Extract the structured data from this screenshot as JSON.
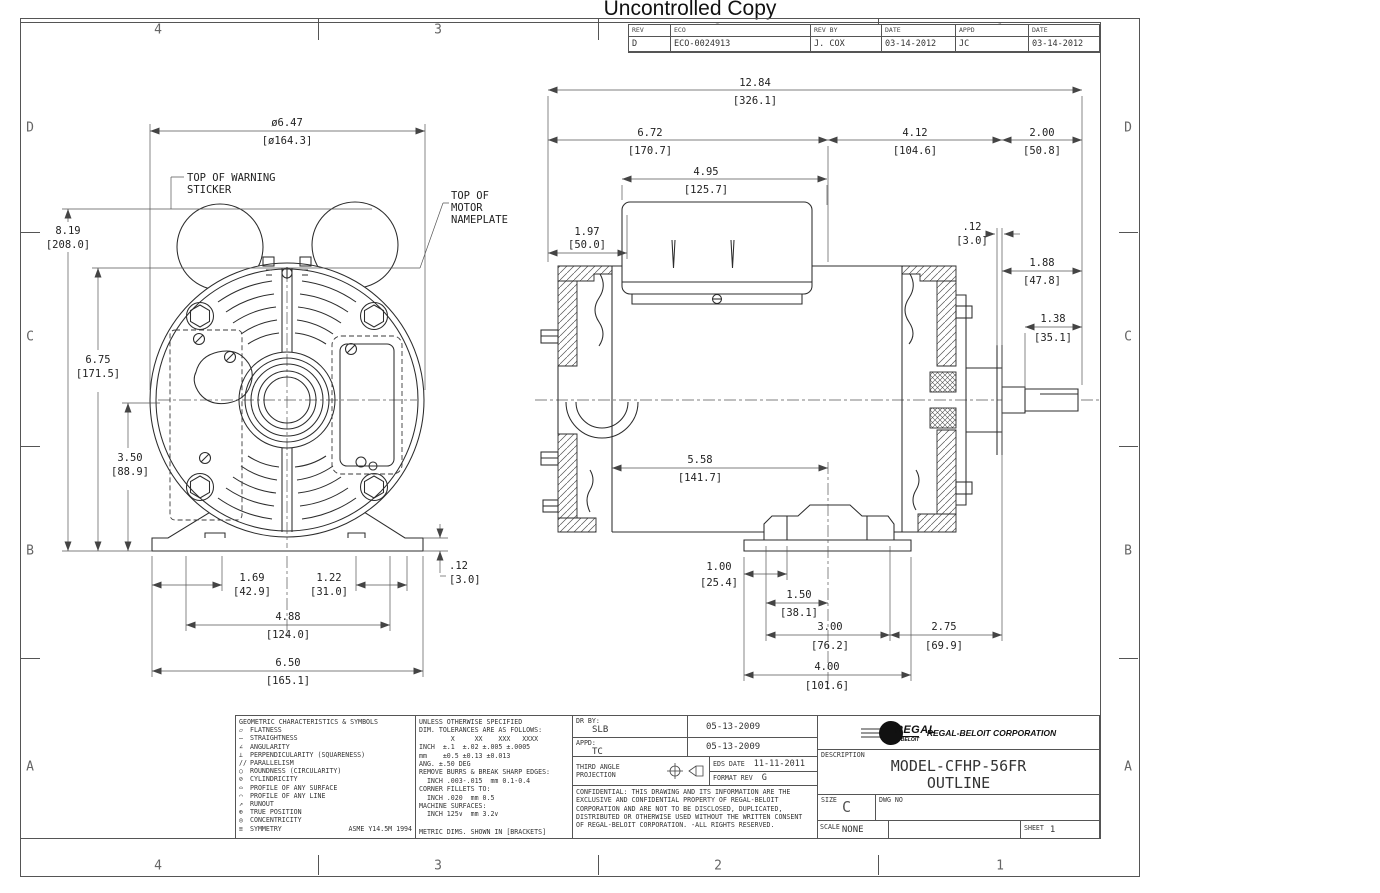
{
  "page_title": "Uncontrolled Copy",
  "sheet": {
    "zones_h": [
      "4",
      "3",
      "2",
      "1"
    ],
    "zones_v": [
      "D",
      "C",
      "B",
      "A"
    ]
  },
  "revision_table": {
    "headers": [
      "REV",
      "ECO",
      "REV BY",
      "DATE",
      "APPD",
      "DATE"
    ],
    "row": [
      "D",
      "ECO-0024913",
      "J. COX",
      "03-14-2012",
      "JC",
      "03-14-2012"
    ]
  },
  "callouts": {
    "warning1": "TOP OF WARNING",
    "warning2": "STICKER",
    "np1": "TOP OF",
    "np2": "MOTOR",
    "np3": "NAMEPLATE"
  },
  "dims": {
    "front": {
      "dia_647": {
        "in": "ø6.47",
        "mm": "[ø164.3]"
      },
      "h_819": {
        "in": "8.19",
        "mm": "[208.0]"
      },
      "h_675": {
        "in": "6.75",
        "mm": "[171.5]"
      },
      "h_350": {
        "in": "3.50",
        "mm": "[88.9]"
      },
      "t_012": {
        "in": ".12",
        "mm": "[3.0]"
      },
      "w_169": {
        "in": "1.69",
        "mm": "[42.9]"
      },
      "w_122": {
        "in": "1.22",
        "mm": "[31.0]"
      },
      "w_488": {
        "in": "4.88",
        "mm": "[124.0]"
      },
      "w_650": {
        "in": "6.50",
        "mm": "[165.1]"
      }
    },
    "side": {
      "len_1284": {
        "in": "12.84",
        "mm": "[326.1]"
      },
      "len_672": {
        "in": "6.72",
        "mm": "[170.7]"
      },
      "len_412": {
        "in": "4.12",
        "mm": "[104.6]"
      },
      "len_200": {
        "in": "2.00",
        "mm": "[50.8]"
      },
      "len_495": {
        "in": "4.95",
        "mm": "[125.7]"
      },
      "len_197": {
        "in": "1.97",
        "mm": "[50.0]"
      },
      "len_012": {
        "in": ".12",
        "mm": "[3.0]"
      },
      "len_188": {
        "in": "1.88",
        "mm": "[47.8]"
      },
      "len_138": {
        "in": "1.38",
        "mm": "[35.1]"
      },
      "len_558": {
        "in": "5.58",
        "mm": "[141.7]"
      },
      "len_100": {
        "in": "1.00",
        "mm": "[25.4]"
      },
      "len_150": {
        "in": "1.50",
        "mm": "[38.1]"
      },
      "len_300": {
        "in": "3.00",
        "mm": "[76.2]"
      },
      "len_275": {
        "in": "2.75",
        "mm": "[69.9]"
      },
      "len_400": {
        "in": "4.00",
        "mm": "[101.6]"
      }
    }
  },
  "title_block": {
    "geometric": {
      "title": "GEOMETRIC CHARACTERISTICS & SYMBOLS",
      "items": [
        {
          "symbol": "▱",
          "label": "FLATNESS"
        },
        {
          "symbol": "—",
          "label": "STRAIGHTNESS"
        },
        {
          "symbol": "∠",
          "label": "ANGULARITY"
        },
        {
          "symbol": "⊥",
          "label": "PERPENDICULARITY (SQUARENESS)"
        },
        {
          "symbol": "//",
          "label": "PARALLELISM"
        },
        {
          "symbol": "○",
          "label": "ROUNDNESS (CIRCULARITY)"
        },
        {
          "symbol": "⊘",
          "label": "CYLINDRICITY"
        },
        {
          "symbol": "⌓",
          "label": "PROFILE OF ANY SURFACE"
        },
        {
          "symbol": "⌒",
          "label": "PROFILE OF ANY LINE"
        },
        {
          "symbol": "↗",
          "label": "RUNOUT"
        },
        {
          "symbol": "⊕",
          "label": "TRUE POSITION"
        },
        {
          "symbol": "◎",
          "label": "CONCENTRICITY"
        },
        {
          "symbol": "≡",
          "label": "SYMMETRY"
        }
      ],
      "standard": "ASME Y14.5M 1994"
    },
    "tolerances": {
      "lines": [
        "UNLESS OTHERWISE SPECIFIED",
        "DIM. TOLERANCES ARE AS FOLLOWS:",
        "        X     XX    XXX   XXXX",
        "INCH  ±.1  ±.02 ±.005 ±.0005",
        "mm    ±0.5 ±0.13 ±0.013",
        "ANG. ±.50 DEG",
        "REMOVE BURRS & BREAK SHARP EDGES:",
        "  INCH .003-.015  mm 0.1-0.4",
        "CORNER FILLETS TO:",
        "  INCH .020  mm 0.5",
        "MACHINE SURFACES:",
        "  INCH 125∨  mm 3.2∨",
        "METRIC DIMS. SHOWN IN [BRACKETS]"
      ]
    },
    "approvals": {
      "dr_label": "DR BY:",
      "dr_name": "SLB",
      "dr_date": "05-13-2009",
      "appd_label": "APPD:",
      "appd_name": "TC",
      "appd_date": "05-13-2009",
      "projection": "THIRD ANGLE PROJECTION",
      "eds_label": "EDS DATE",
      "eds_date": "11-11-2011",
      "format_label": "FORMAT REV",
      "format_rev": "G"
    },
    "confidential": "CONFIDENTIAL: THIS DRAWING AND ITS INFORMATION ARE THE EXCLUSIVE AND CONFIDENTIAL PROPERTY OF REGAL-BELOIT CORPORATION AND ARE NOT TO BE DISCLOSED, DUPLICATED, DISTRIBUTED OR OTHERWISE USED WITHOUT THE WRITTEN CONSENT OF REGAL-BELOIT CORPORATION. -ALL RIGHTS RESERVED.",
    "company": {
      "logo_regal": "REGAL",
      "logo_beloit": "BELOIT",
      "name": "REGAL-BELOIT CORPORATION",
      "description_label": "DESCRIPTION",
      "description_line1": "MODEL-CFHP-56FR",
      "description_line2": "OUTLINE",
      "size_label": "SIZE",
      "size": "C",
      "dwg_no_label": "DWG NO",
      "scale_label": "SCALE",
      "scale": "NONE",
      "sheet_label": "SHEET",
      "sheet": "1"
    }
  }
}
